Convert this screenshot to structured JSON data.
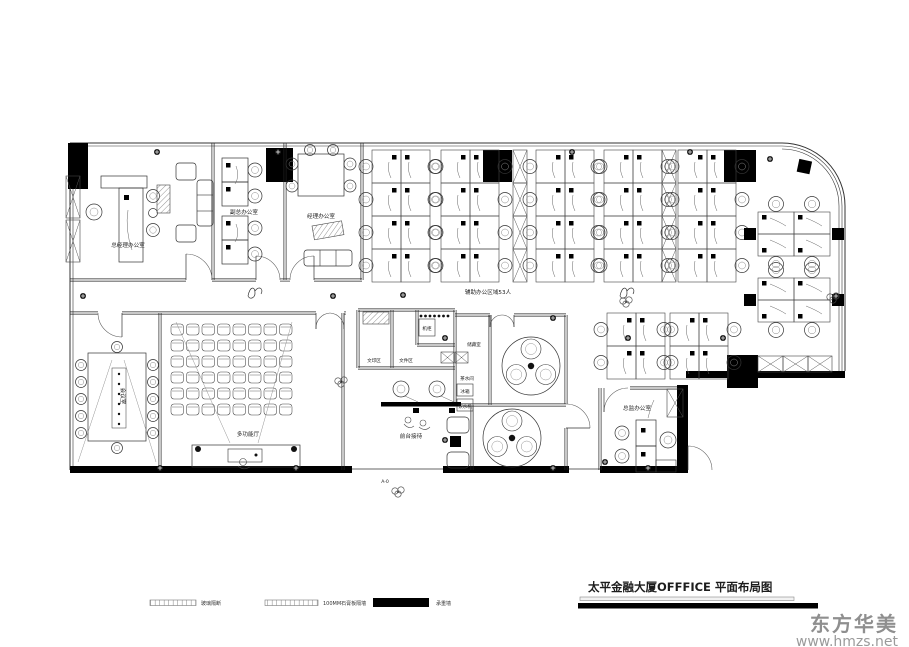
{
  "meta": {
    "drawing_title": "太平金融大厦OFFFICE  平面布局图"
  },
  "watermark": {
    "brand": "东方华美",
    "url": "www.hmzs.net"
  },
  "legend": [
    {
      "label": "玻璃隔断",
      "style": "glass"
    },
    {
      "label": "100MM石膏板隔墙",
      "style": "gypsum"
    },
    {
      "label": "承重墙",
      "style": "solid",
      "color": "#000000"
    }
  ],
  "labels": {
    "gm_office": "总经理办公室",
    "deputy_office": "副总办公室",
    "manager_office": "经理办公室",
    "meeting_room": "会议室",
    "multi_hall": "多功能厅",
    "director_office": "总监办公室",
    "storage": "储藏室",
    "pantry": "茶水间",
    "fridge": "冰箱",
    "water": "饮水机",
    "print_area": "文印区",
    "file_area": "文件区",
    "cabinet": "机柜",
    "area_note": "辅助办公区域53人",
    "reception": "前台接待",
    "entry": "A-0"
  },
  "colors": {
    "line": "#333333",
    "wall_fill": "#000000",
    "background": "#ffffff",
    "watermark": "#999999"
  }
}
